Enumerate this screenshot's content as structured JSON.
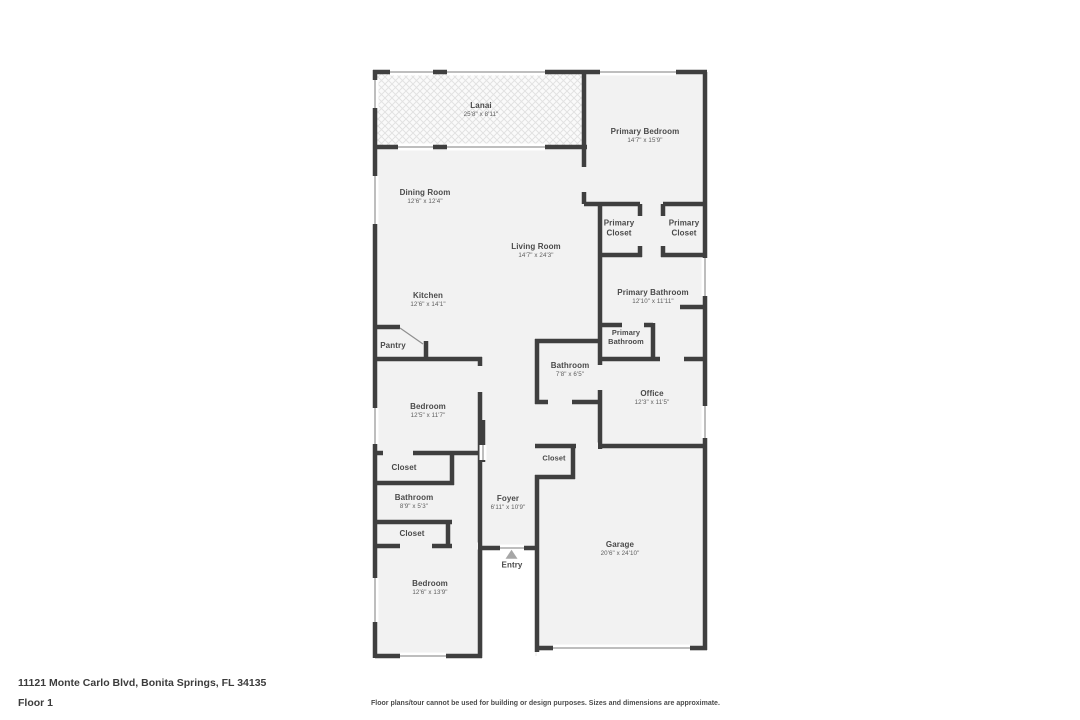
{
  "page": {
    "address": "11121 Monte Carlo Blvd, Bonita Springs, FL 34135",
    "floor_label": "Floor 1",
    "disclaimer": "Floor plans/tour cannot be used for building or design purposes. Sizes and dimensions are approximate."
  },
  "colors": {
    "wall": "#3f3f3f",
    "room_fill": "#f2f2f2",
    "lanai_fill": "#fafafa",
    "window_line": "#a8a8a8",
    "text": "#4a4a4a"
  },
  "rooms": [
    {
      "id": "lanai",
      "name": "Lanai",
      "dims": "25'8\" x 8'11\""
    },
    {
      "id": "primary-bedroom",
      "name": "Primary Bedroom",
      "dims": "14'7\" x 15'9\""
    },
    {
      "id": "dining-room",
      "name": "Dining Room",
      "dims": "12'6\" x 12'4\""
    },
    {
      "id": "primary-closet-left",
      "name": "Primary Closet",
      "dims": ""
    },
    {
      "id": "primary-closet-right",
      "name": "Primary Closet",
      "dims": ""
    },
    {
      "id": "living-room",
      "name": "Living Room",
      "dims": "14'7\" x 24'3\""
    },
    {
      "id": "kitchen",
      "name": "Kitchen",
      "dims": "12'6\" x 14'1\""
    },
    {
      "id": "primary-bathroom",
      "name": "Primary Bathroom",
      "dims": "12'10\" x 11'11\""
    },
    {
      "id": "pantry",
      "name": "Pantry",
      "dims": ""
    },
    {
      "id": "primary-bathroom-wc",
      "name": "Primary Bathroom",
      "dims": ""
    },
    {
      "id": "bathroom-main",
      "name": "Bathroom",
      "dims": "7'8\" x 6'5\""
    },
    {
      "id": "office",
      "name": "Office",
      "dims": "12'3\" x 11'5\""
    },
    {
      "id": "bedroom-middle",
      "name": "Bedroom",
      "dims": "12'5\" x 11'7\""
    },
    {
      "id": "closet-bedroom",
      "name": "Closet",
      "dims": ""
    },
    {
      "id": "bathroom-guest",
      "name": "Bathroom",
      "dims": "8'9\" x 5'3\""
    },
    {
      "id": "foyer",
      "name": "Foyer",
      "dims": "6'11\" x 10'9\""
    },
    {
      "id": "closet-foyer",
      "name": "Closet",
      "dims": ""
    },
    {
      "id": "closet-hall",
      "name": "Closet",
      "dims": ""
    },
    {
      "id": "garage",
      "name": "Garage",
      "dims": "20'6\" x 24'10\""
    },
    {
      "id": "bedroom-front",
      "name": "Bedroom",
      "dims": "12'6\" x 13'9\""
    },
    {
      "id": "entry",
      "name": "Entry",
      "dims": ""
    }
  ]
}
